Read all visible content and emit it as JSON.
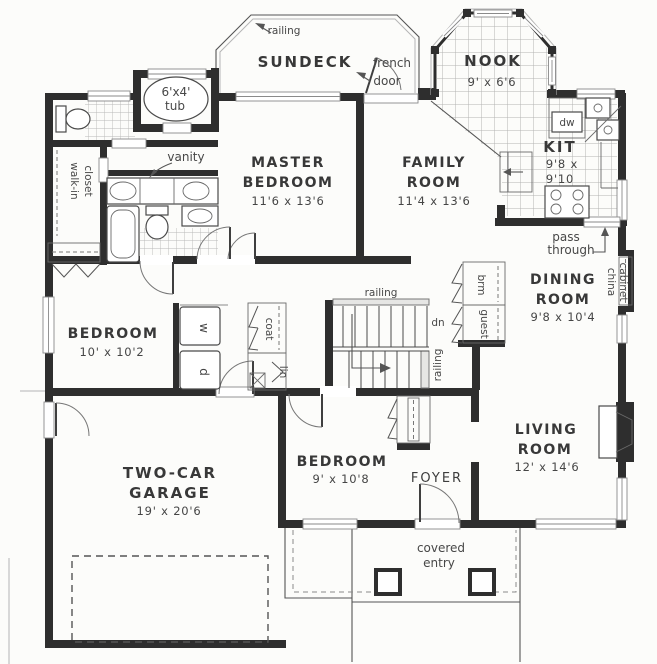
{
  "rooms": {
    "sundeck": {
      "name": "SUNDECK"
    },
    "nook": {
      "name": "NOOK",
      "dims": "9' x 6'6"
    },
    "kitchen": {
      "name": "KIT",
      "dims1": "9'8 x",
      "dims2": "9'10"
    },
    "master_bedroom": {
      "name1": "MASTER",
      "name2": "BEDROOM",
      "dims": "11'6 x 13'6"
    },
    "family_room": {
      "name1": "FAMILY",
      "name2": "ROOM",
      "dims": "11'4 x 13'6"
    },
    "dining_room": {
      "name1": "DINING",
      "name2": "ROOM",
      "dims": "9'8 x 10'4"
    },
    "living_room": {
      "name1": "LIVING",
      "name2": "ROOM",
      "dims": "12' x 14'6"
    },
    "bedroom_left": {
      "name": "BEDROOM",
      "dims": "10' x 10'2"
    },
    "bedroom_lower": {
      "name": "BEDROOM",
      "dims": "9' x 10'8"
    },
    "garage": {
      "name1": "TWO-CAR",
      "name2": "GARAGE",
      "dims": "19' x 20'6"
    },
    "foyer": {
      "name": "FOYER"
    },
    "covered_entry": {
      "line1": "covered",
      "line2": "entry"
    }
  },
  "annotations": {
    "railing_sundeck": "railing",
    "railing_stairs_top": "railing",
    "railing_stairs_side": "railing",
    "french1": "french",
    "french2": "door",
    "tub1": "6'x4'",
    "tub2": "tub",
    "vanity": "vanity",
    "walkin1": "walk-in",
    "walkin2": "closet",
    "dw": "dw",
    "pass1": "pass",
    "pass2": "through",
    "china1": "china",
    "china2": "cabinet",
    "brm": "brm",
    "guest": "guest",
    "coat": "coat",
    "lin": "lin",
    "washer": "w",
    "dryer": "d",
    "dn": "dn"
  },
  "colors": {
    "wall": "#2e2e2e",
    "line": "#555555",
    "tile": "#b3b3b3",
    "text": "#383838",
    "background": "#fcfcfa"
  }
}
